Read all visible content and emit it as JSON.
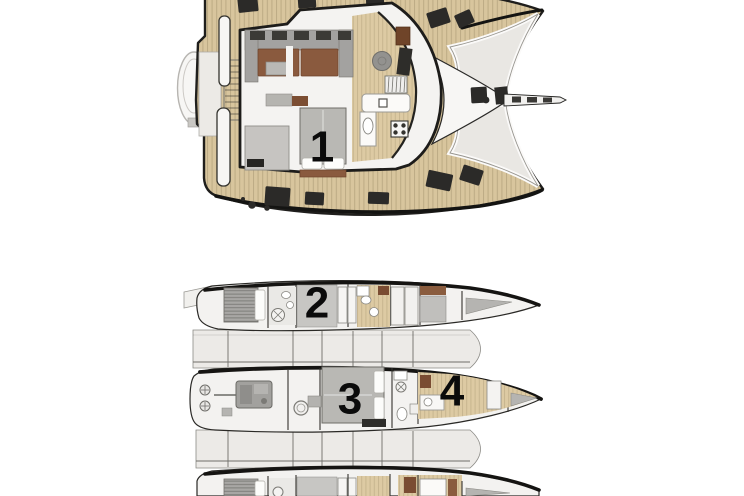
{
  "diagram": {
    "type": "boat-floor-plan",
    "plans": {
      "main_deck": {
        "cabins": [
          {
            "id": "cabin-1",
            "label": "1"
          }
        ]
      },
      "lower_deck": {
        "cabins": [
          {
            "id": "cabin-2",
            "label": "2"
          },
          {
            "id": "cabin-3",
            "label": "3"
          },
          {
            "id": "cabin-4",
            "label": "4"
          }
        ]
      }
    },
    "colors": {
      "background": "#ffffff",
      "deck_wood": "#d8c59d",
      "interior_wood": "#ddcaa3",
      "hull_outline": "#1f1e1c",
      "trampoline": "#e9e7e3",
      "hull_fill": "#f3f2f0",
      "furniture_gray": "#a9a8a5",
      "cushion_brown": "#8a5a3e",
      "hatch_dark": "#2b2a28",
      "label_color": "#0b0b0b"
    }
  }
}
